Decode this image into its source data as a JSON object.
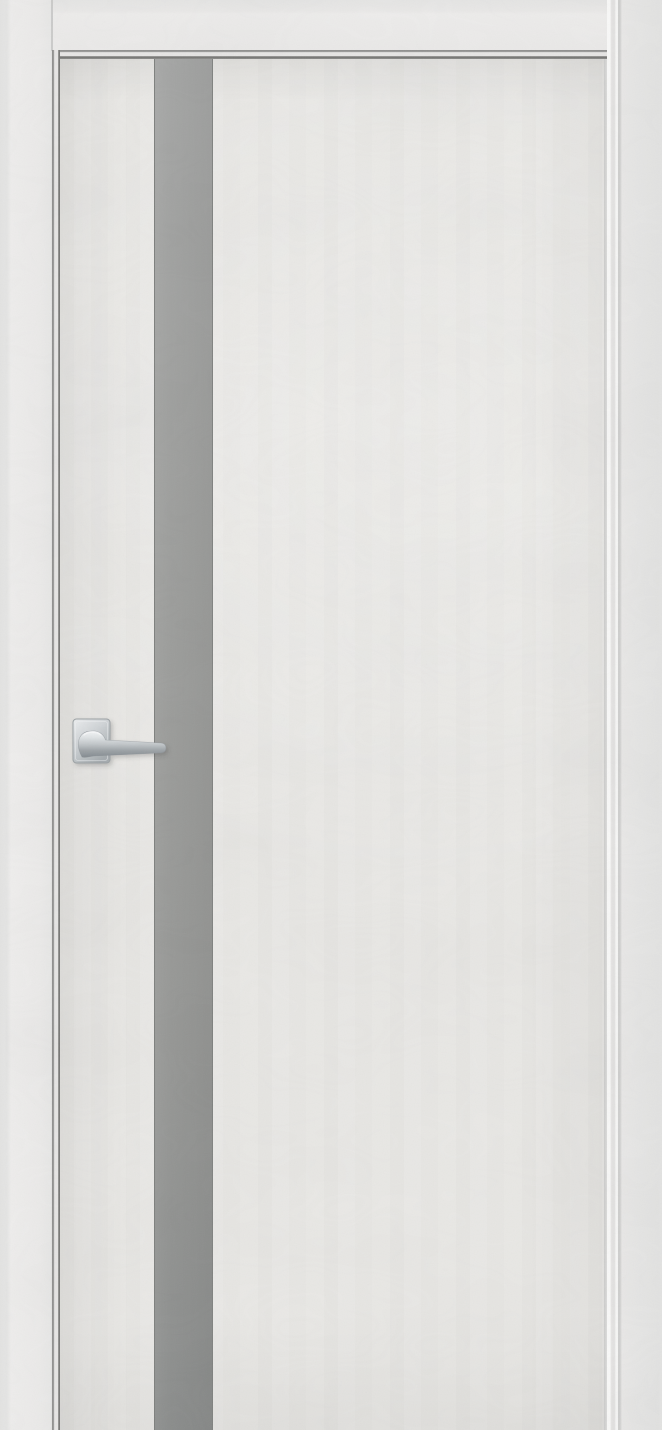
{
  "meta": {
    "domain": "natural-image",
    "subject": "Product photo of a light grey interior door with vertical glass insert",
    "description": "Studio photograph of a closed modern interior door in a matching frame. The leaf has a light grey concrete-look finish, a full-height matte grey glass stripe near the hinge side, and a polished chrome lever handle on a square rosette pointing right. The image is cropped before the floor, so no threshold is visible."
  },
  "door": {
    "frame_label": "Door frame casing in matching light grey finish",
    "leaf_label": "Door leaf with light grey concrete-look surface",
    "glass_label": "Full-height matte grey glass insert stripe",
    "glass_finish": "matte grey",
    "handle_label": "Polished chrome lever handle on square rosette",
    "handle_finish": "polished chrome",
    "handle_orientation": "lever pointing right, tip overlapping glass stripe",
    "visible_parts": [
      "left frame jamb",
      "top frame header",
      "right frame jamb with lit stop profile",
      "door leaf",
      "vertical glass insert",
      "lever handle with square rosette"
    ]
  },
  "colors": {
    "wall_frame": "#eaeaea",
    "frame_edge_shadow": "#dcdcdb",
    "reveal_line_light": "#8f8f8e",
    "reveal_line_dark": "#767674",
    "door_leaf": "#e9e8e5",
    "leaf_edge": "#cbcbca",
    "glass_top": "#a3a4a3",
    "glass_mid": "#98999a",
    "glass_bottom": "#8a8c8b",
    "glass_edge": "#7d7f7d",
    "stop_highlight": "#f9f9f8",
    "chrome_highlight": "#f3f5f6",
    "chrome_mid": "#c6cbce",
    "chrome_shadow": "#848b90"
  }
}
